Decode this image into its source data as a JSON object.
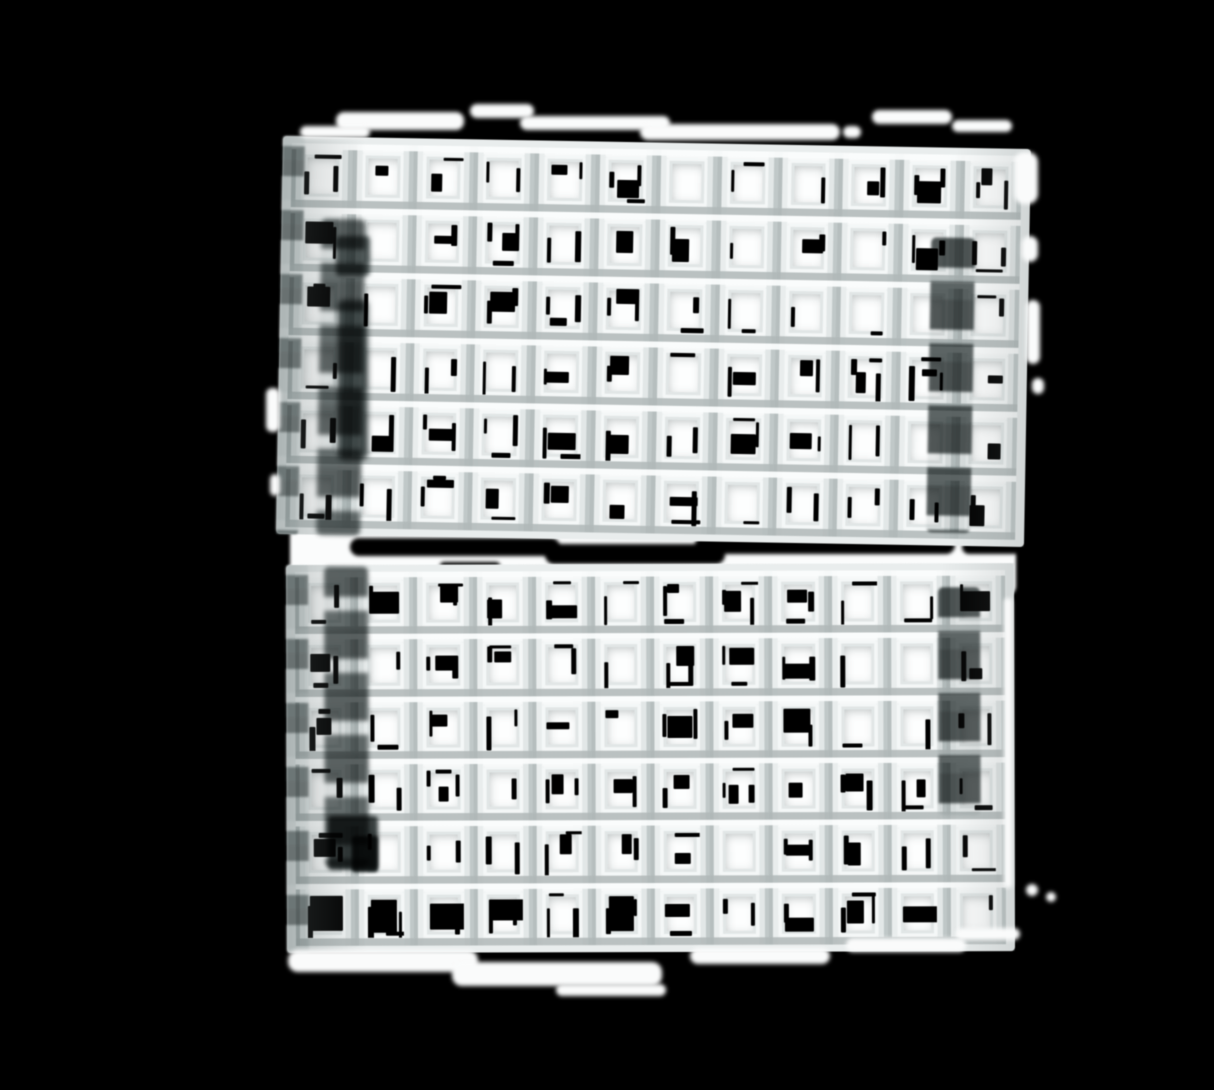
{
  "scene": {
    "description": "Photograph of two stacked white egg-crate grid panels (square lattice louvers) isolated on a black background, soft focus, with darker recessed vertical channels near the left and right side of each panel, white blur artifacts along the outer edges, and black speckle noise showing through the square openings.",
    "background_color": "#000000"
  },
  "colors": {
    "background": "#000000",
    "wall_bright": "#f7f9f9",
    "wall_light": "#e9eded",
    "wall_light2": "#e2e7e7",
    "wall_mid": "#c0c8c8",
    "wall_dark": "#b6bebe",
    "opening": "#fdfefe",
    "frame_inner": "#f4f7f7",
    "frame_line": "#e1e6e6",
    "depth_shadow": "rgba(104,114,114,0.45)",
    "noise_black": "#000000",
    "channel_dark": "#3e4545",
    "channel_mid": "#4c5454",
    "channel_gap": "rgba(195,202,202,0.35)",
    "blob_white": "#fafbfb",
    "gap_white": "#fbfcfc"
  },
  "noise": {
    "seed": 1337,
    "left_dash_prob": 0.65,
    "right_dash_prob": 0.6,
    "patch_prob": 0.55,
    "hdash_prob": 0.35
  },
  "panels": [
    {
      "id": "top-grid-panel",
      "left": 283,
      "top": 136,
      "width": 748,
      "height": 398,
      "rotate": 1.0,
      "cols": 12,
      "rows": 6,
      "bottom_row_scale": 1.0,
      "edge_strip_width": 22,
      "channels": [
        {
          "id": "top-left-shadow-channel",
          "x": 40,
          "y": 82,
          "w": 44,
          "h": 316,
          "blur": 2.5,
          "opacity": 0.85
        },
        {
          "id": "top-right-shadow-channel",
          "x": 650,
          "y": 90,
          "w": 44,
          "h": 295,
          "blur": 1.4,
          "opacity": 0.9
        }
      ]
    },
    {
      "id": "bottom-grid-panel",
      "left": 286,
      "top": 565,
      "width": 728,
      "height": 388,
      "rotate": -0.15,
      "cols": 12,
      "rows": 6,
      "bottom_row_scale": 1.6,
      "edge_strip_width": 22,
      "channels": [
        {
          "id": "bottom-left-shadow-channel",
          "x": 38,
          "y": 2,
          "w": 44,
          "h": 300,
          "blur": 2.2,
          "opacity": 0.85
        },
        {
          "id": "bottom-right-shadow-channel",
          "x": 652,
          "y": 24,
          "w": 42,
          "h": 228,
          "blur": 1.4,
          "opacity": 0.9
        }
      ]
    }
  ],
  "gap_band": {
    "x": 290,
    "y": 504,
    "width": 726,
    "height": 92,
    "streaks": [
      {
        "x": 60,
        "y": 34,
        "w": 210,
        "h": 18
      },
      {
        "x": 255,
        "y": 40,
        "w": 180,
        "h": 20
      },
      {
        "x": 405,
        "y": 32,
        "w": 260,
        "h": 18
      },
      {
        "x": 672,
        "y": 36,
        "w": 60,
        "h": 14
      },
      {
        "x": 150,
        "y": 58,
        "w": 60,
        "h": 8
      }
    ]
  },
  "dark_patches": [
    {
      "x": 328,
      "y": 816,
      "w": 50,
      "h": 54,
      "color": "#3a4141",
      "blur": 2,
      "radius": 4
    },
    {
      "x": 352,
      "y": 836,
      "w": 26,
      "h": 36,
      "color": "#2f3636",
      "blur": 1.5,
      "radius": 3
    },
    {
      "x": 336,
      "y": 236,
      "w": 34,
      "h": 40,
      "color": "#565e5e",
      "blur": 2.5,
      "radius": 4
    },
    {
      "x": 338,
      "y": 300,
      "w": 30,
      "h": 160,
      "color": "#4a5252",
      "blur": 3,
      "radius": 6
    }
  ],
  "edge_blobs": [
    {
      "x": 336,
      "y": 112,
      "w": 128,
      "h": 18,
      "r": 8
    },
    {
      "x": 300,
      "y": 126,
      "w": 70,
      "h": 12,
      "r": 6
    },
    {
      "x": 470,
      "y": 104,
      "w": 64,
      "h": 14,
      "r": 7
    },
    {
      "x": 520,
      "y": 116,
      "w": 150,
      "h": 14,
      "r": 7
    },
    {
      "x": 640,
      "y": 124,
      "w": 200,
      "h": 16,
      "r": 8
    },
    {
      "x": 843,
      "y": 126,
      "w": 18,
      "h": 12,
      "r": 6
    },
    {
      "x": 872,
      "y": 110,
      "w": 80,
      "h": 14,
      "r": 7
    },
    {
      "x": 952,
      "y": 120,
      "w": 60,
      "h": 12,
      "r": 6
    },
    {
      "x": 1014,
      "y": 152,
      "w": 24,
      "h": 52,
      "r": 10
    },
    {
      "x": 1022,
      "y": 236,
      "w": 16,
      "h": 26,
      "r": 8
    },
    {
      "x": 1026,
      "y": 300,
      "w": 14,
      "h": 64,
      "r": 7
    },
    {
      "x": 1032,
      "y": 378,
      "w": 12,
      "h": 16,
      "r": 6
    },
    {
      "x": 266,
      "y": 388,
      "w": 14,
      "h": 44,
      "r": 6
    },
    {
      "x": 270,
      "y": 474,
      "w": 10,
      "h": 22,
      "r": 5
    },
    {
      "x": 288,
      "y": 950,
      "w": 190,
      "h": 22,
      "r": 10
    },
    {
      "x": 452,
      "y": 962,
      "w": 210,
      "h": 24,
      "r": 10
    },
    {
      "x": 556,
      "y": 984,
      "w": 110,
      "h": 12,
      "r": 6
    },
    {
      "x": 690,
      "y": 948,
      "w": 140,
      "h": 16,
      "r": 8
    },
    {
      "x": 846,
      "y": 938,
      "w": 120,
      "h": 14,
      "r": 7
    },
    {
      "x": 956,
      "y": 928,
      "w": 64,
      "h": 12,
      "r": 6
    },
    {
      "x": 1004,
      "y": 598,
      "w": 8,
      "h": 290,
      "r": 4
    },
    {
      "x": 1026,
      "y": 884,
      "w": 12,
      "h": 12,
      "r": 6
    },
    {
      "x": 1046,
      "y": 892,
      "w": 10,
      "h": 10,
      "r": 5
    }
  ]
}
